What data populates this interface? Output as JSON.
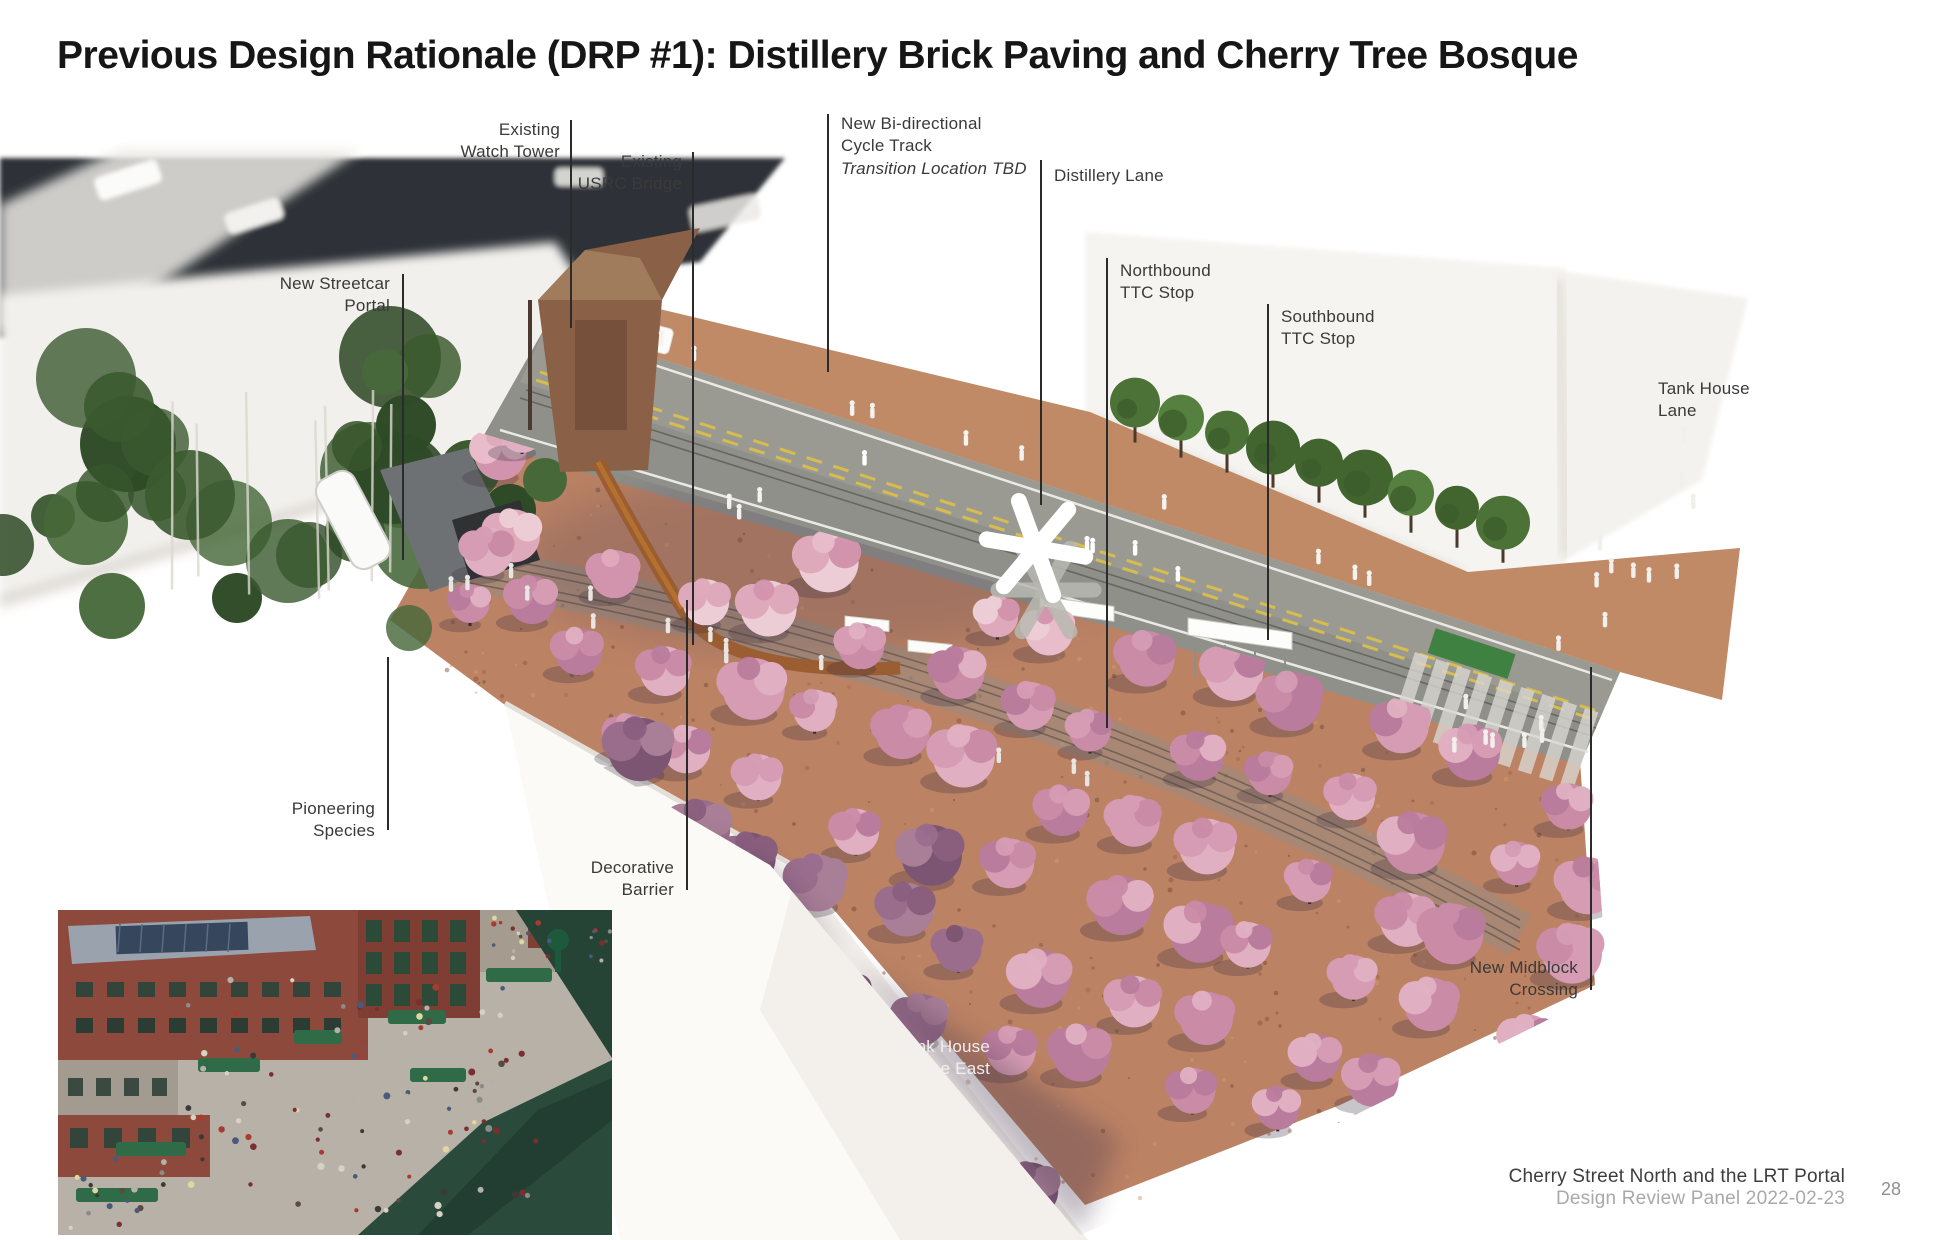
{
  "title": "Previous Design Rationale (DRP #1): Distillery Brick Paving and Cherry Tree Bosque",
  "callouts": {
    "watch_tower": {
      "lines": [
        "Existing",
        "Watch Tower"
      ]
    },
    "usrc_bridge": {
      "lines": [
        "Existing",
        "USRC Bridge"
      ]
    },
    "cycle_track": {
      "lines": [
        "New Bi-directional",
        "Cycle Track"
      ],
      "note": "Transition Location TBD"
    },
    "distillery_lane": {
      "lines": [
        "Distillery Lane",
        ""
      ]
    },
    "northbound_ttc": {
      "lines": [
        "Northbound",
        "TTC Stop"
      ]
    },
    "southbound_ttc": {
      "lines": [
        "Southbound",
        "TTC Stop"
      ]
    },
    "tank_house_lane": {
      "lines": [
        "Tank House",
        "Lane"
      ]
    },
    "streetcar_portal": {
      "lines": [
        "New Streetcar",
        "Portal"
      ]
    },
    "pioneering_species": {
      "lines": [
        "Pioneering",
        "Species"
      ]
    },
    "decorative_barrier": {
      "lines": [
        "Decorative",
        "Barrier"
      ]
    },
    "tank_house_lane_east": {
      "lines": [
        "Tank House",
        "Lane East"
      ]
    },
    "midblock_crossing": {
      "lines": [
        "New Midblock",
        "Crossing"
      ]
    }
  },
  "landmark_marker": "asterisk-sculpture",
  "footer": {
    "project": "Cherry Street North and the LRT Portal",
    "panel": "Design Review Panel 2022-02-23",
    "page": "28"
  },
  "colors": {
    "brick": "#bc8767",
    "road": "#8f8f88",
    "cherry_light": "#dfa9bc",
    "cherry_dark": "#8a5f7e",
    "tree_green": "#4c7238",
    "corten": "#9a5c2e"
  }
}
